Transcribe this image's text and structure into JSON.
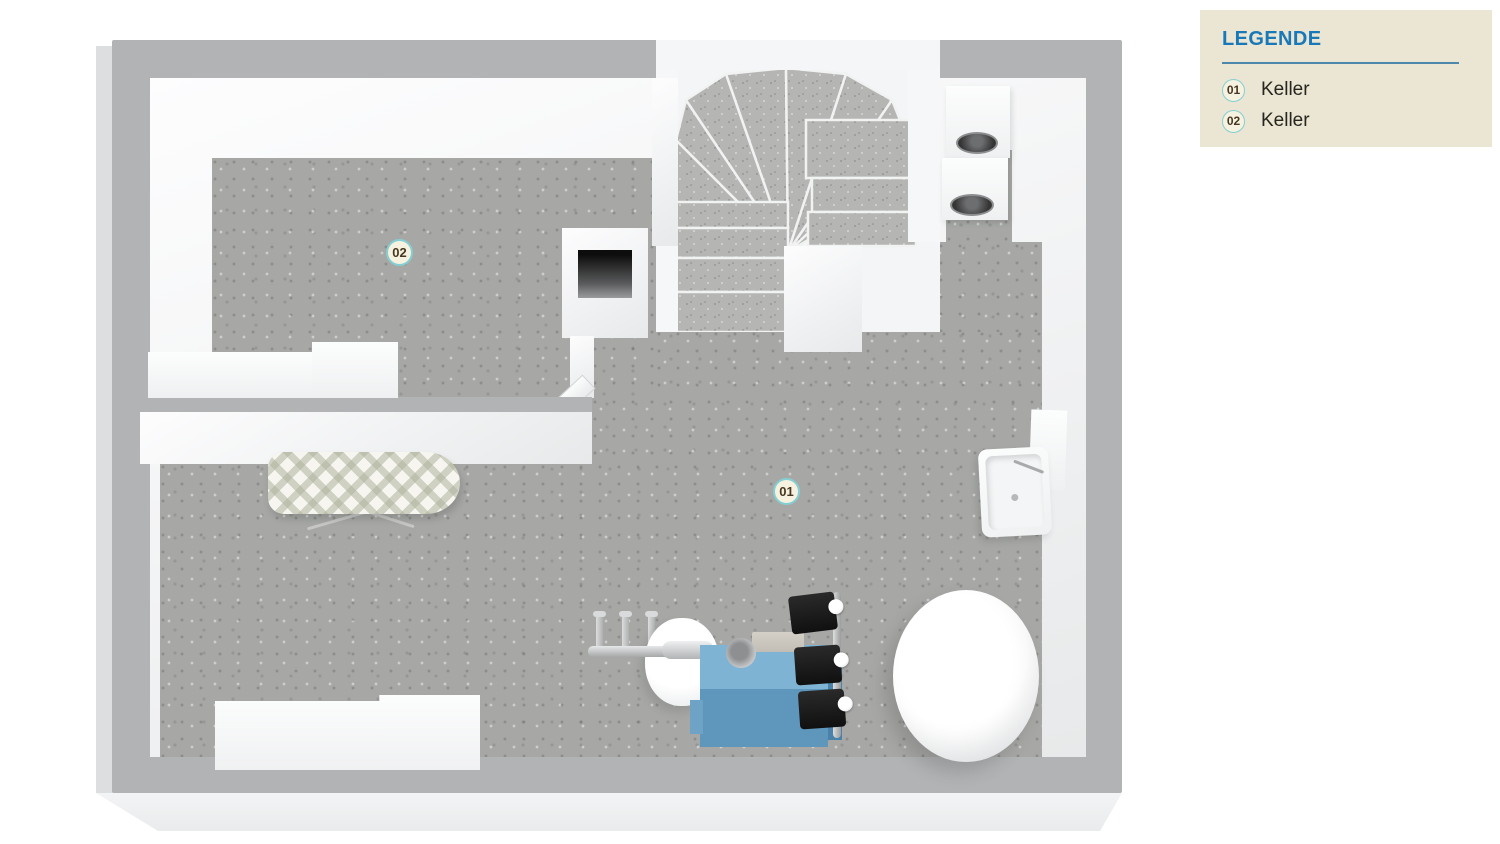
{
  "legend": {
    "title": "LEGENDE",
    "items": [
      {
        "id": "01",
        "label": "Keller"
      },
      {
        "id": "02",
        "label": "Keller"
      }
    ]
  },
  "floorplan": {
    "badges": {
      "room01": "01",
      "room02": "02"
    },
    "rooms": [
      {
        "badge": "01",
        "name": "Keller"
      },
      {
        "badge": "02",
        "name": "Keller"
      }
    ],
    "objects": [
      "winder-staircase",
      "washer-dryer-stack",
      "chimney-shaft",
      "open-door",
      "counter",
      "ironing-board",
      "chest-freezer",
      "utility-sink",
      "wall-shelf",
      "hot-water-tank",
      "boiler",
      "boiler-valves",
      "expansion-vessel",
      "heating-manifold",
      "flue-pipe"
    ]
  },
  "theme": {
    "legend_bg": "#ebe5d3",
    "legend_title": "#1878b8",
    "legend_rule": "#4d87ab",
    "legend_text": "#26261f",
    "badge_bg": "#f6f2df",
    "badge_ring": "#84cfd3",
    "badge_text": "#463823",
    "wall_top": "#b1b3b5",
    "floor": "#a7a8a6",
    "boiler_top": "#7fb3d4",
    "boiler_front": "#5e96bc",
    "boiler_side": "#4a82a9"
  }
}
